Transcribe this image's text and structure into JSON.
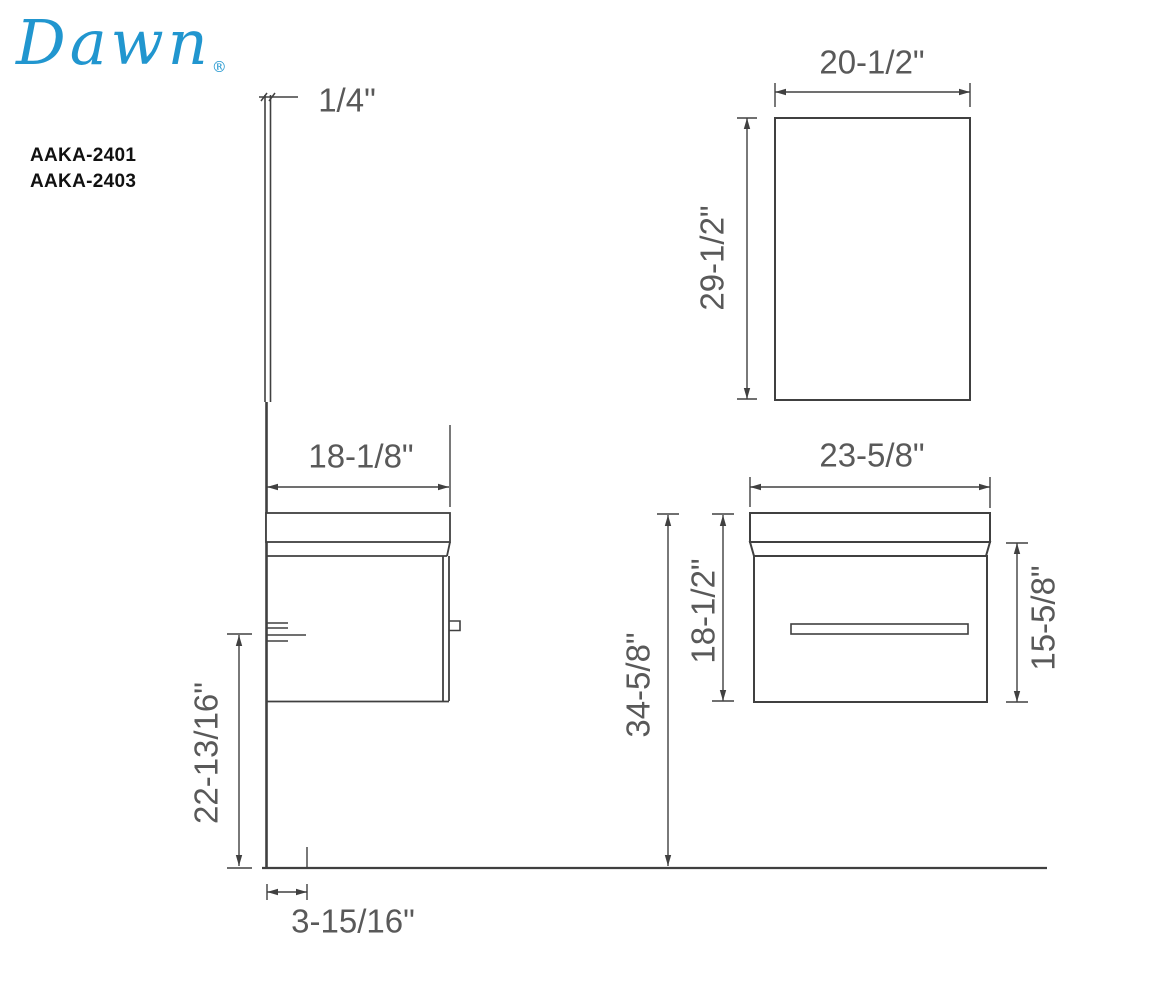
{
  "brand": {
    "name": "Dawn",
    "mark": "®"
  },
  "models": [
    "AAKA-2401",
    "AAKA-2403"
  ],
  "dimensions": {
    "mirror_thickness": "1/4\"",
    "mirror_width": "20-1/2\"",
    "mirror_height": "29-1/2\"",
    "vanity_depth": "18-1/8\"",
    "floor_to_cabinet_bottom": "22-13/16\"",
    "wall_offset": "3-15/16\"",
    "vanity_width": "23-5/8\"",
    "counter_to_bottom_height": "18-1/2\"",
    "overall_height": "34-5/8\"",
    "cabinet_side_height": "15-5/8\""
  },
  "colors": {
    "logo_blue": "#2196cf",
    "line_gray": "#404040",
    "dim_text_gray": "#595959"
  }
}
